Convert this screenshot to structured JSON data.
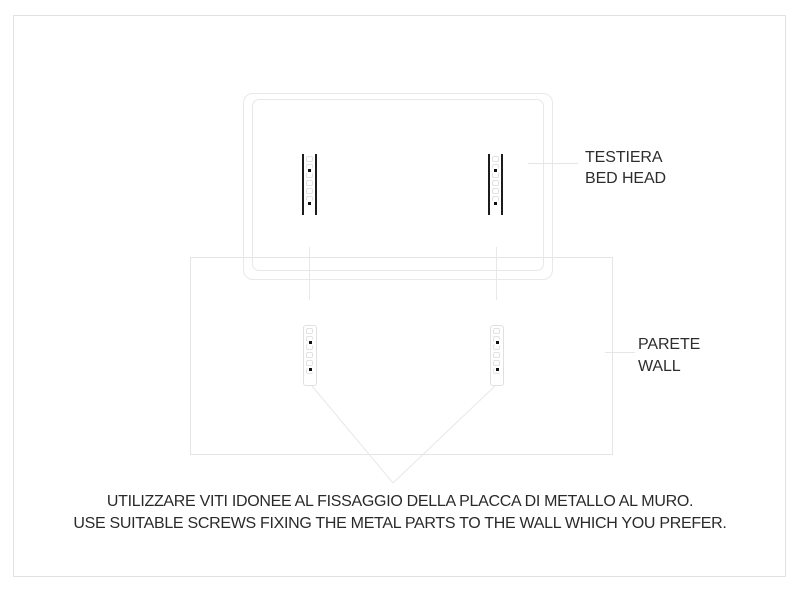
{
  "diagram": {
    "bed_head_label": {
      "line1": "TESTIERA",
      "line2": "BED HEAD"
    },
    "wall_label": {
      "line1": "PARETE",
      "line2": "WALL"
    },
    "footer": {
      "line1": "UTILIZZARE VITI IDONEE AL FISSAGGIO DELLA PLACCA DI METALLO AL MURO.",
      "line2": "USE SUITABLE SCREWS FIXING THE METAL PARTS TO THE WALL WHICH YOU PREFER."
    },
    "colors": {
      "background": "#ffffff",
      "outline_light": "#e5e5e5",
      "plate_dark": "#1c1c1c",
      "slot_outline": "#e2e2e2",
      "text": "#2d2d2d"
    }
  }
}
